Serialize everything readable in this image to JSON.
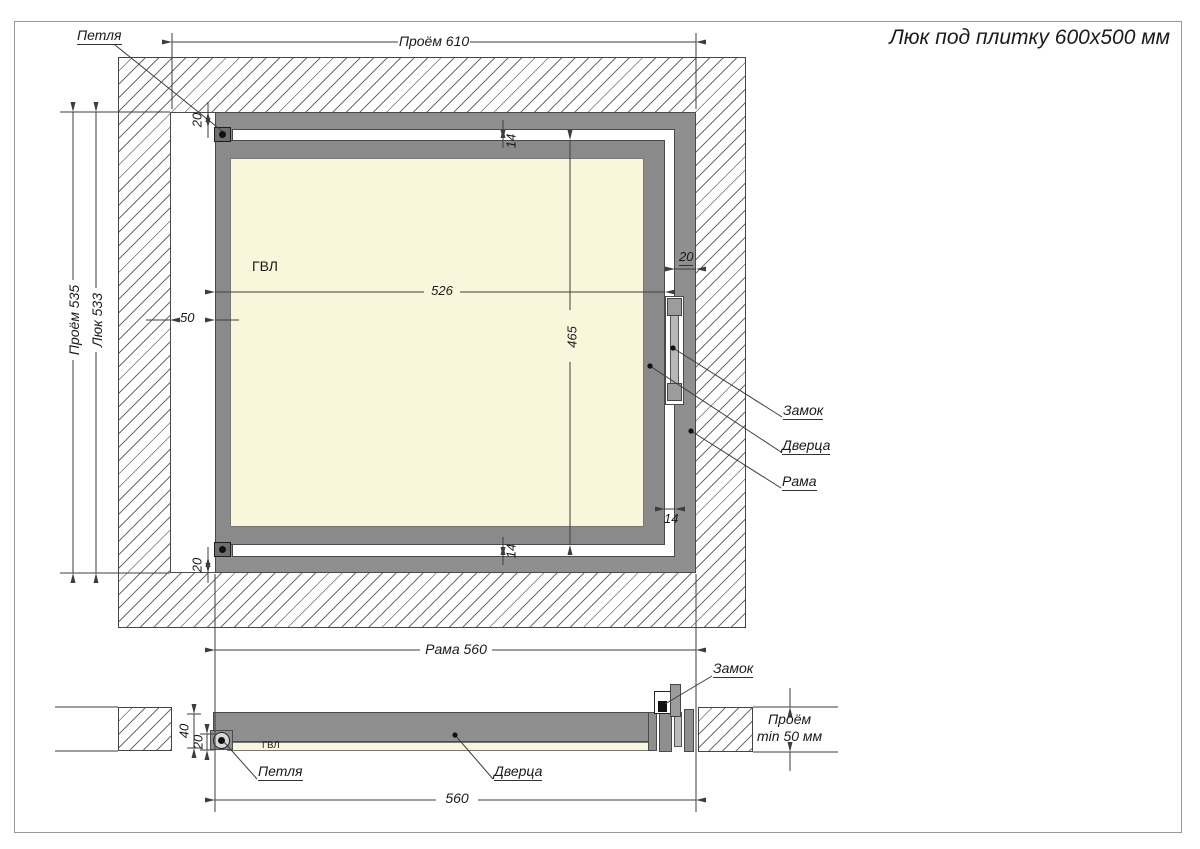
{
  "title": "Люк под плитку 600х500 мм",
  "colors": {
    "frame": "#8f8f8f",
    "door": "#8a8a8a",
    "panel": "#f9f6dc",
    "line": "#3d3d3d"
  },
  "main": {
    "hinge_label": "Петля",
    "opening_width": "Проём 610",
    "opening_height": "Проём 535",
    "hatch_height": "Люк 533",
    "gvl_label": "ГВЛ",
    "door_width": "526",
    "door_height": "465",
    "side_gap": "50",
    "frame_thickness_top": "20",
    "frame_thickness_bottom": "20",
    "frame_thickness_right": "20",
    "gap_top": "14",
    "gap_bottom": "14",
    "gap_right": "14",
    "lock_label": "Замок",
    "door_label": "Дверца",
    "frame_label": "Рама",
    "frame_width": "Рама 560"
  },
  "section": {
    "gvl_label": "ГВЛ",
    "hinge_label": "Петля",
    "door_label": "Дверца",
    "lock_label": "Замок",
    "total_thickness": "40",
    "door_thickness": "20",
    "frame_width": "560",
    "depth_line1": "Проём",
    "depth_line2": "min 50 мм"
  }
}
